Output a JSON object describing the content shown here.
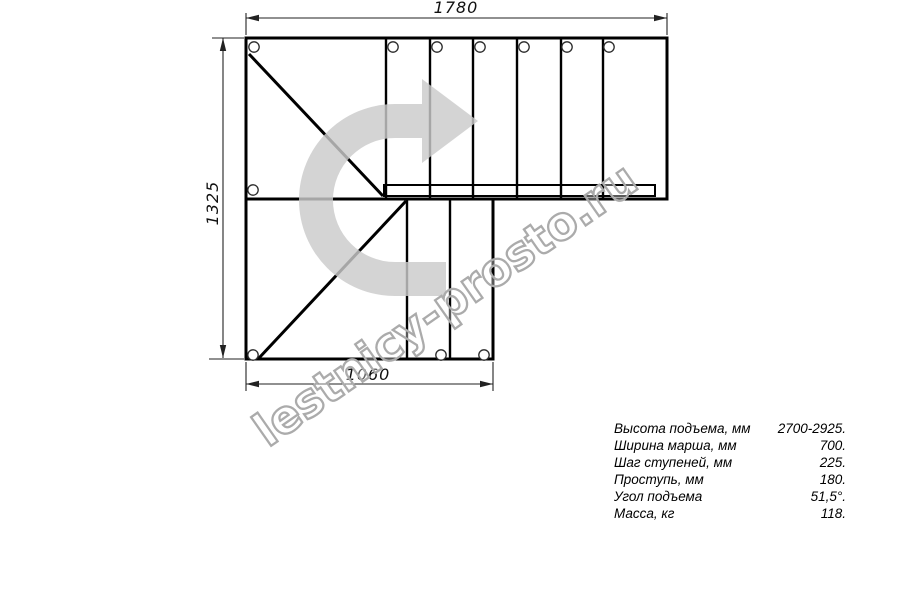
{
  "drawing": {
    "title": "L-shaped staircase plan view",
    "dimensions": {
      "top": "1780",
      "left": "1325",
      "bottom": "1060"
    },
    "watermark": "lestnicy-prosto.ru",
    "colors": {
      "line": "#000000",
      "arrow_fill": "#cbcbcb",
      "watermark_stroke": "#ababab"
    }
  },
  "specs": {
    "rows": [
      {
        "label": "Высота подъема, мм",
        "value": "2700-2925."
      },
      {
        "label": "Ширина марша, мм",
        "value": "700."
      },
      {
        "label": "Шаг ступеней, мм",
        "value": "225."
      },
      {
        "label": "Проступь, мм",
        "value": "180."
      },
      {
        "label": "Угол подъема",
        "value": "51,5°."
      },
      {
        "label": "Масса, кг",
        "value": "118."
      }
    ]
  }
}
